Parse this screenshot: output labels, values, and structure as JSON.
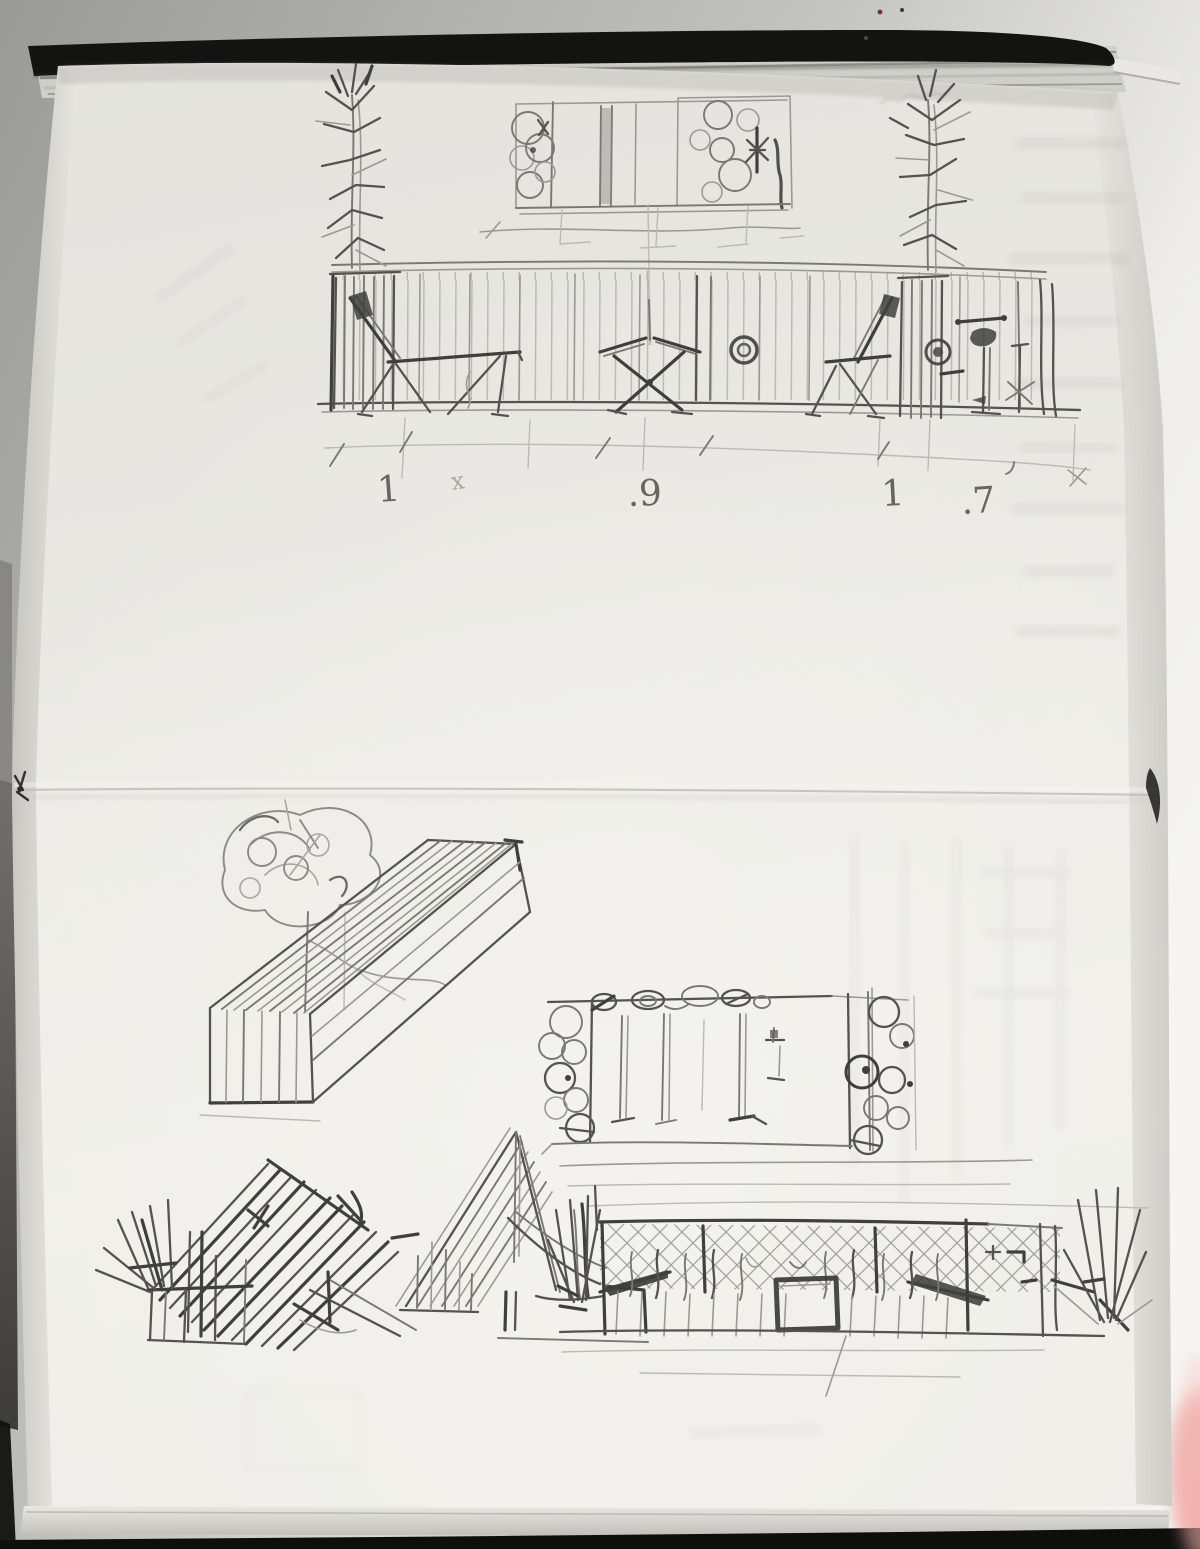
{
  "notebook": {
    "dimension_labels": [
      "1",
      "x",
      ".9",
      "1",
      ".7"
    ]
  },
  "colors": {
    "background_gray": "#9a9a96",
    "background_light": "#f4f3f0",
    "cover_black": "#131312",
    "page_edge_stack": "#cfcfca",
    "paper": "#edece7",
    "pencil_dark": "#3f3f3c",
    "pencil_mid": "#7a7873",
    "pencil_light": "#b0aea7",
    "crease_line": "#c2c0ba",
    "pink_blur": "#f2b0ac"
  }
}
